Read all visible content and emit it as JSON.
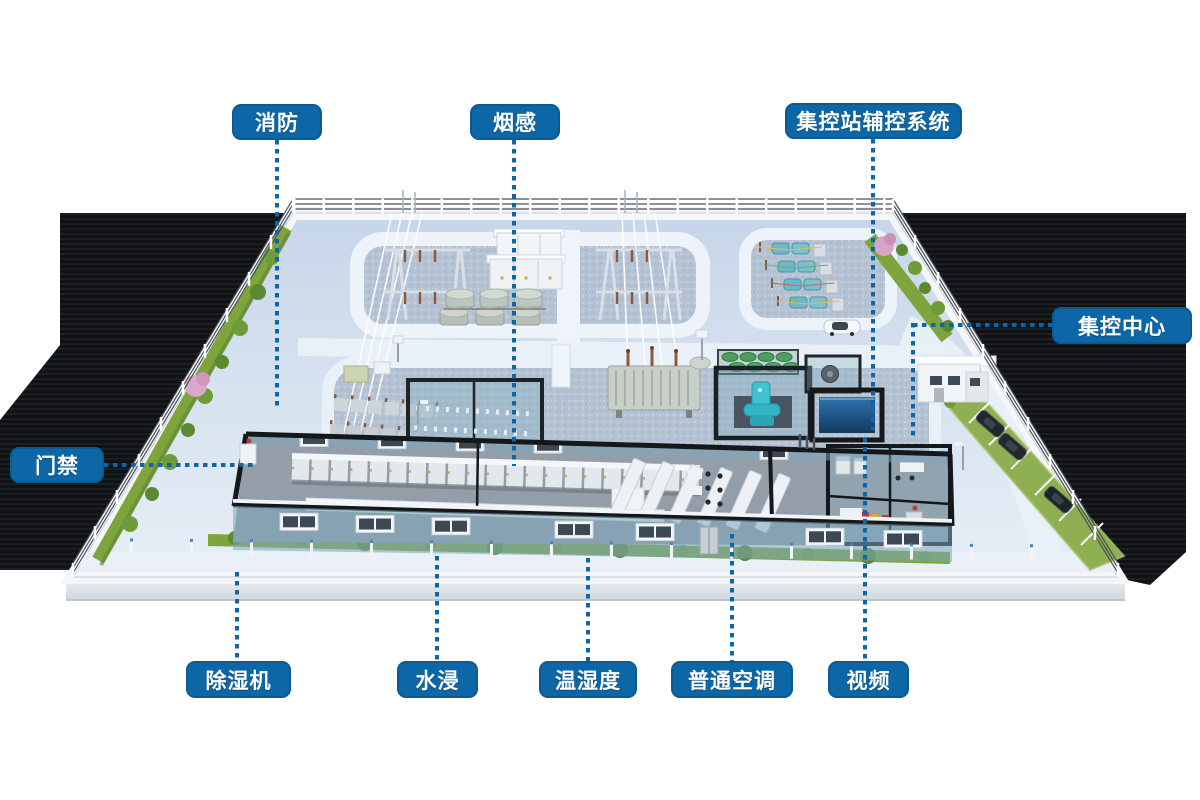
{
  "scene": {
    "name": "substation-3d-site",
    "background": "#ffffff",
    "accent": "#0d67a6",
    "connector_style": "dotted"
  },
  "labels": [
    {
      "id": "fire",
      "text": "消防"
    },
    {
      "id": "smoke-detector",
      "text": "烟感"
    },
    {
      "id": "aux-control-system",
      "text": "集控站辅控系统"
    },
    {
      "id": "control-center",
      "text": "集控中心"
    },
    {
      "id": "access-control",
      "text": "门禁"
    },
    {
      "id": "dehumidifier",
      "text": "除湿机"
    },
    {
      "id": "water-leak",
      "text": "水浸"
    },
    {
      "id": "temperature-humidity",
      "text": "温湿度"
    },
    {
      "id": "standard-ac",
      "text": "普通空调"
    },
    {
      "id": "video",
      "text": "视频"
    }
  ]
}
